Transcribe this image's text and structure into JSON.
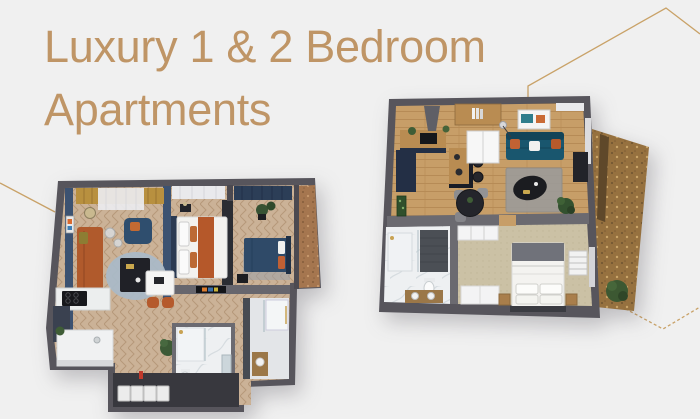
{
  "page": {
    "width": 700,
    "height": 419,
    "background_color": "#f0f0f0",
    "description": "Marketing banner with two 3D apartment floor plans"
  },
  "heading": {
    "line1": "Luxury 1 & 2 Bedroom",
    "line2": "Apartments",
    "color": "#bf9566"
  },
  "decor": {
    "line_color": "#c9a268",
    "shapes": [
      "hexagon-outline-top-right",
      "hexagon-outline-left",
      "hexagon-outline-bottom-right-dashed"
    ]
  },
  "floorplans": [
    {
      "name": "two-bedroom-apartment-3d-floorplan",
      "position": "bottom-left",
      "rooms": [
        "living-room",
        "bedroom-1",
        "bedroom-2",
        "kitchen",
        "marble-bathroom",
        "shower-room",
        "laundry-storage",
        "cork-balcony",
        "hall-with-desk"
      ]
    },
    {
      "name": "one-bedroom-apartment-3d-floorplan",
      "position": "top-right",
      "rooms": [
        "kitchen",
        "living-room",
        "dining-area",
        "entry-closet",
        "bedroom",
        "bathroom",
        "balcony-terrace"
      ]
    }
  ],
  "palette": {
    "background": "#f0f0f0",
    "title_gold": "#bf9566",
    "decor_line": "#c9a268",
    "wall_dark": "#57555c",
    "wall_mid": "#6b6a70",
    "accent_navy_wall": "#3c5271",
    "gold_curtain": "#b8903f",
    "orange_sofa": "#b05a2c",
    "teal_sofa": "#19566e",
    "navy_bed": "#2f4a68",
    "herringbone_wood": "#cbb297",
    "plank_wood": "#c79e68",
    "beige_carpet": "#cbc1a5",
    "marble": "#eef0f2",
    "cork_balcony": "#a5764f",
    "terrace_brown": "#96713f",
    "plant_green": "#3f5d36"
  }
}
